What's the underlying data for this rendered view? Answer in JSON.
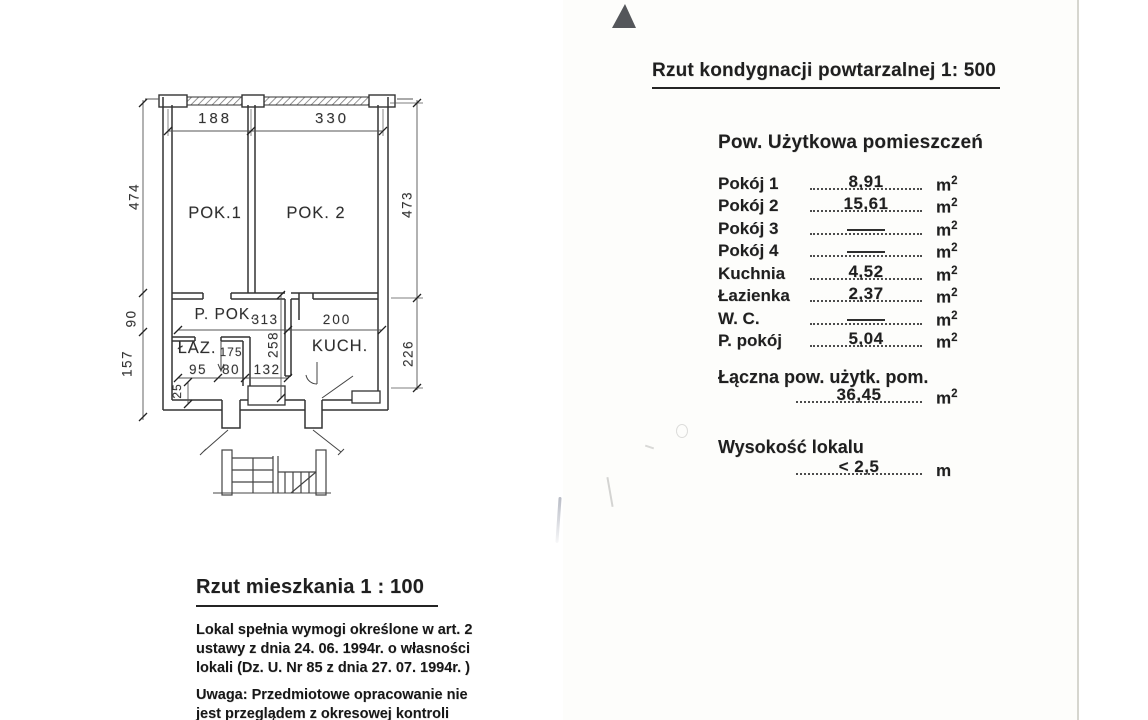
{
  "header": {
    "title": "Rzut kondygnacji powtarzalnej  1: 500"
  },
  "areas": {
    "title": "Pow. Użytkowa pomieszczeń",
    "unit": "m",
    "unit_sup": "2",
    "rows": [
      {
        "label": "Pokój 1",
        "value": "8,91",
        "dash": false
      },
      {
        "label": "Pokój 2",
        "value": "15,61",
        "dash": false
      },
      {
        "label": "Pokój 3",
        "value": "",
        "dash": true
      },
      {
        "label": "Pokój 4",
        "value": "",
        "dash": true
      },
      {
        "label": "Kuchnia",
        "value": "4,52",
        "dash": false
      },
      {
        "label": "Łazienka",
        "value": "2,37",
        "dash": false
      },
      {
        "label": "W. C.",
        "value": "",
        "dash": true
      },
      {
        "label": "P. pokój",
        "value": "5,04",
        "dash": false
      }
    ],
    "total_label": "Łączna pow. użytk. pom.",
    "total_value": "36,45",
    "height_label": "Wysokość lokalu",
    "height_value": "< 2,5",
    "height_unit": "m"
  },
  "plan": {
    "rooms": {
      "pok1": "POK.1",
      "pok2": "POK. 2",
      "ppok": "P. POK.",
      "laz": "ŁAZ.",
      "kuch": "KUCH."
    },
    "dims": {
      "top_left": "188",
      "top_right": "330",
      "left_main": "474",
      "left_mid": "90",
      "left_low": "157",
      "right_main": "473",
      "right_low": "226",
      "hall": "313",
      "kuch_width": "200",
      "laz": "175",
      "corridor": "258",
      "b1": "95",
      "b2": "80",
      "b3": "132",
      "small": "25"
    }
  },
  "footer": {
    "title": "Rzut mieszkania   1 : 100",
    "para1_lines": [
      "Lokal spełnia wymogi określone w art. 2",
      "ustawy z dnia 24. 06. 1994r. o własności",
      "lokali (Dz. U. Nr 85 z dnia 27. 07. 1994r. )"
    ],
    "note_label": "Uwaga:",
    "note_line1": " Przedmiotowe opracowanie nie",
    "note_line2": "jest przeglądem z okresowej kontroli"
  }
}
